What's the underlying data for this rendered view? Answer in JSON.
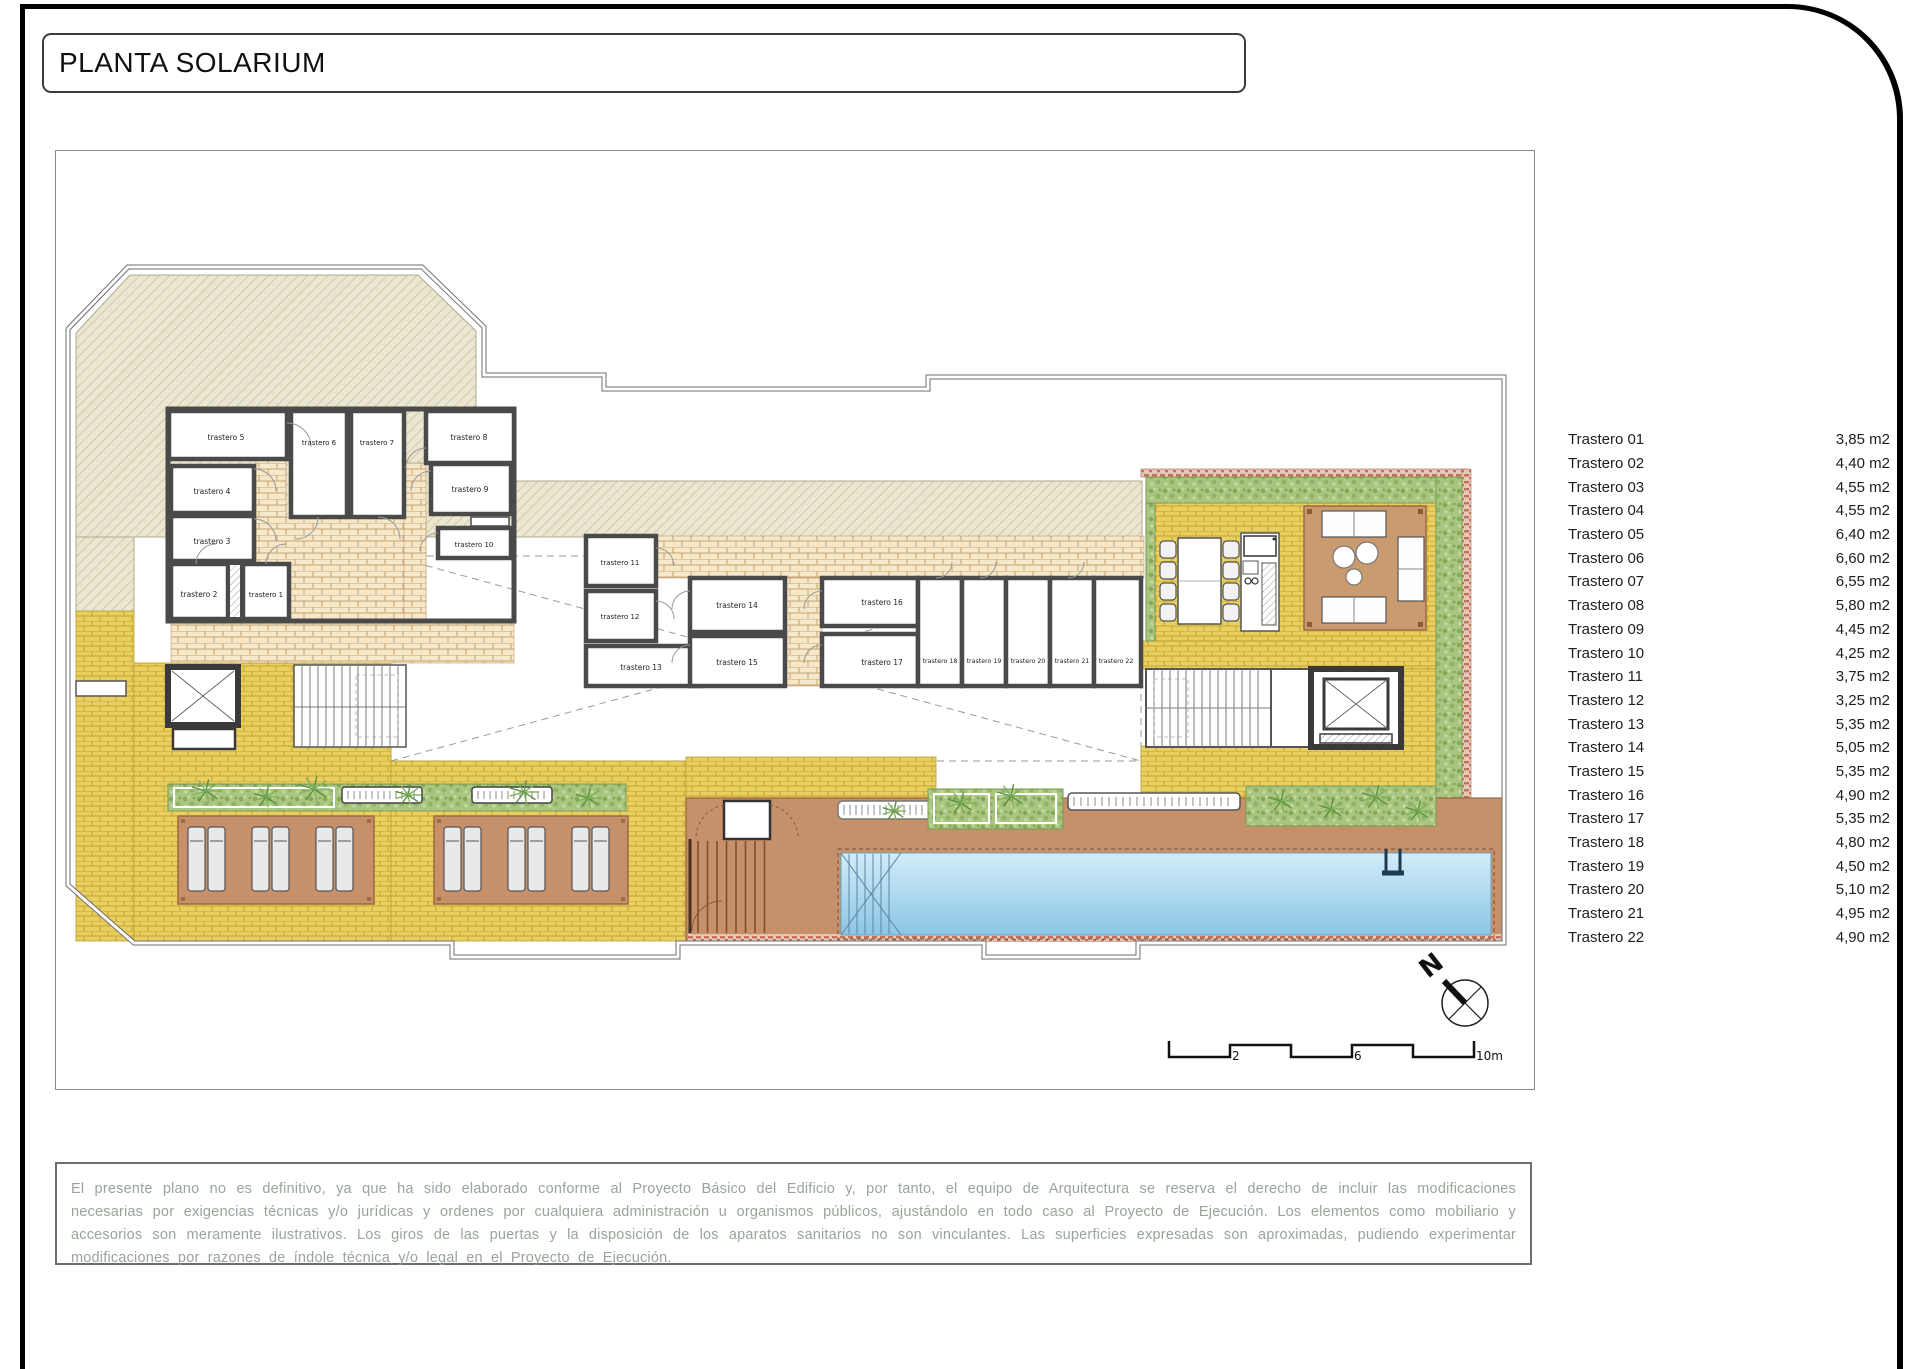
{
  "title": "PLANTA SOLARIUM",
  "plan": {
    "rooms": [
      "trastero 1",
      "trastero 2",
      "trastero 3",
      "trastero 4",
      "trastero 5",
      "trastero 6",
      "trastero 7",
      "trastero 8",
      "trastero 9",
      "trastero 10",
      "trastero 11",
      "trastero 12",
      "trastero 13",
      "trastero 14",
      "trastero 15",
      "trastero 16",
      "trastero 17",
      "trastero 18",
      "trastero 19",
      "trastero 20",
      "trastero 21",
      "trastero 22"
    ],
    "scale_labels": [
      "2",
      "6",
      "10m"
    ],
    "north_label": "N"
  },
  "legend": {
    "items": [
      {
        "name": "Trastero 01",
        "area": "3,85 m2"
      },
      {
        "name": "Trastero 02",
        "area": "4,40 m2"
      },
      {
        "name": "Trastero 03",
        "area": "4,55 m2"
      },
      {
        "name": "Trastero 04",
        "area": "4,55 m2"
      },
      {
        "name": "Trastero 05",
        "area": "6,40 m2"
      },
      {
        "name": "Trastero 06",
        "area": "6,60 m2"
      },
      {
        "name": "Trastero 07",
        "area": "6,55 m2"
      },
      {
        "name": "Trastero 08",
        "area": "5,80 m2"
      },
      {
        "name": "Trastero 09",
        "area": "4,45 m2"
      },
      {
        "name": "Trastero 10",
        "area": "4,25 m2"
      },
      {
        "name": "Trastero 11",
        "area": "3,75 m2"
      },
      {
        "name": "Trastero 12",
        "area": "3,25 m2"
      },
      {
        "name": "Trastero 13",
        "area": "5,35 m2"
      },
      {
        "name": "Trastero 14",
        "area": "5,05 m2"
      },
      {
        "name": "Trastero 15",
        "area": "5,35 m2"
      },
      {
        "name": "Trastero 16",
        "area": "4,90 m2"
      },
      {
        "name": "Trastero 17",
        "area": "5,35 m2"
      },
      {
        "name": "Trastero 18",
        "area": "4,80 m2"
      },
      {
        "name": "Trastero 19",
        "area": "4,50 m2"
      },
      {
        "name": "Trastero 20",
        "area": "5,10 m2"
      },
      {
        "name": "Trastero 21",
        "area": "4,95 m2"
      },
      {
        "name": "Trastero 22",
        "area": "4,90 m2"
      }
    ]
  },
  "disclaimer": "El presente plano no es definitivo, ya que ha sido elaborado conforme al Proyecto Básico del Edificio y, por tanto, el equipo de Arquitectura se reserva el derecho de incluir las modificaciones necesarias por exigencias técnicas y/o jurídicas y ordenes por cualquiera administración u organismos públicos, ajustándolo en todo caso al Proyecto de Ejecución. Los elementos como mobiliario y accesorios son meramente ilustrativos. Los giros de las puertas y la disposición de los aparatos sanitarios no son vinculantes. Las superficies expresadas son aproximadas, pudiendo experimentar modificaciones por razones de índole técnica y/o legal en el Proyecto de Ejecución.",
  "colors": {
    "wall": "#4a4a4a",
    "deck_yellow": "#e9cf5f",
    "corridor_tan": "#f5e8cb",
    "deck_brown": "#c6906b",
    "pool_blue": "#9fd2ec",
    "hedge_green": "#a9c57f",
    "trim_red": "#c97f6a",
    "note_text": "#9aa49a"
  }
}
